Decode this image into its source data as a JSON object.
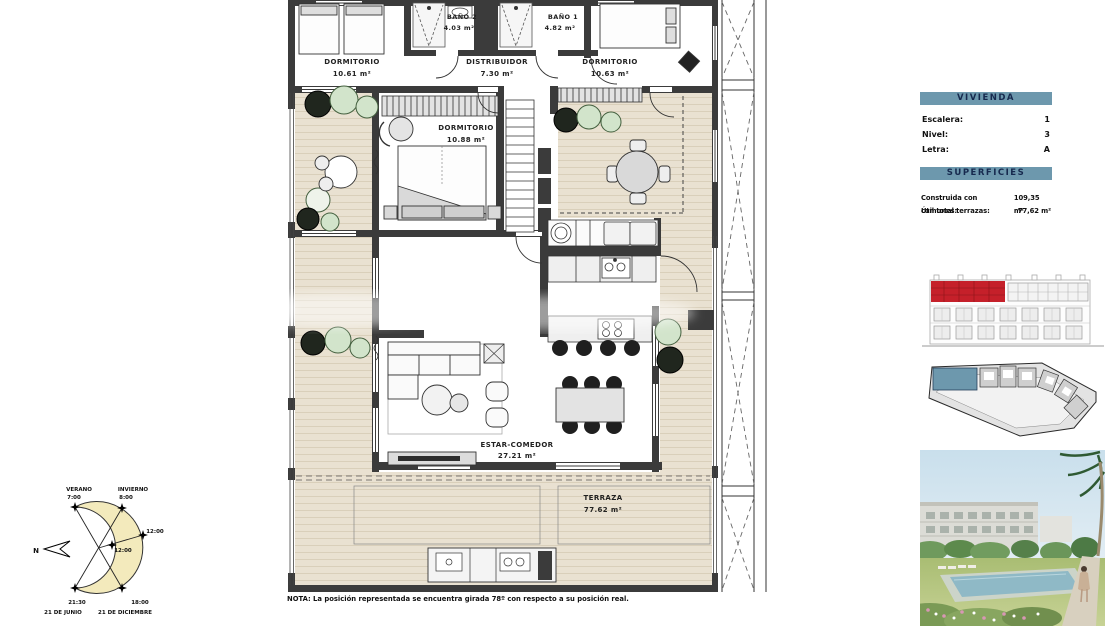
{
  "floor_plan": {
    "rooms": {
      "dormitorio_izq": {
        "name": "DORMITORIO",
        "area": "10.61 m²"
      },
      "bano2": {
        "name": "BAÑO 2",
        "area": "4.03 m²"
      },
      "distribuidor": {
        "name": "DISTRIBUIDOR",
        "area": "7.30 m²"
      },
      "bano1": {
        "name": "BAÑO 1",
        "area": "4.82 m²"
      },
      "dormitorio_der": {
        "name": "DORMITORIO",
        "area": "10.63 m²"
      },
      "dormitorio_ppal": {
        "name": "DORMITORIO",
        "area": "10.88 m²"
      },
      "estar_comedor": {
        "name": "ESTAR-COMEDOR",
        "area": "27.21 m²"
      },
      "terraza": {
        "name": "TERRAZA",
        "area": "77.62 m²"
      }
    },
    "note": "NOTA: La posición representada se encuentra girada 78º con respecto a su posición real."
  },
  "sun_diagram": {
    "north": "N",
    "verano_label": "VERANO",
    "verano_sunrise": "7:00",
    "invierno_label": "INVIERNO",
    "invierno_sunrise": "8:00",
    "noon_invierno": "12:00",
    "noon_verano": "12:00",
    "verano_sunset": "21:30",
    "verano_date": "21 DE JUNIO",
    "invierno_sunset": "18:00",
    "invierno_date": "21 DE DICIEMBRE"
  },
  "info_panel": {
    "vivienda_title": "VIVIENDA",
    "vivienda_rows": [
      {
        "label": "Escalera:",
        "value": "1"
      },
      {
        "label": "Nivel:",
        "value": "3"
      },
      {
        "label": "Letra:",
        "value": "A"
      }
    ],
    "superficies_title": "SUPERFICIES",
    "superficies_rows": [
      {
        "label": "Construida con comunes:",
        "value": "109,35 m²"
      },
      {
        "label": "Útil total terrazas:",
        "value": "77,62 m²"
      }
    ]
  },
  "colors": {
    "panel_header_bg": "#6d98ad",
    "panel_header_text": "#16294e",
    "facade_highlight_red": "#c5202a",
    "siteplan_highlight_blue": "#6d98ad",
    "terrace_wood": "#e9e1d1",
    "wall": "#3b3b3b",
    "sun_diagram_fill": "#f3eabc"
  }
}
